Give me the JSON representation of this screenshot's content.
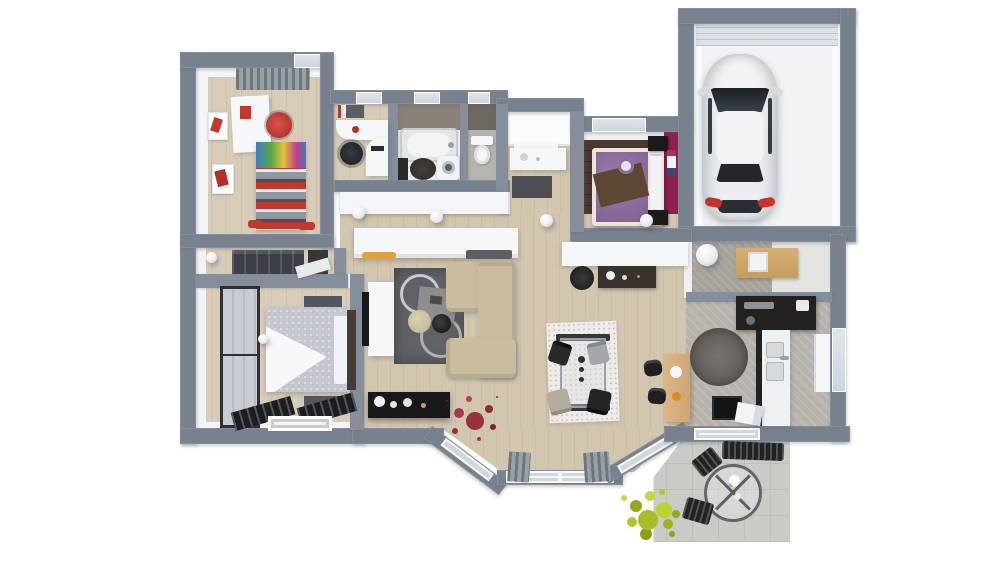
{
  "scene": {
    "description": "3D top-down cutaway floor plan render of a single-storey house with attached garage and outdoor terrace, white background, no text labels",
    "view": "top-down 3d cutaway",
    "palette": {
      "exterior_wall": "#78828f",
      "interior_wall": "#858e9a",
      "wood_floor": "#d8ccb8",
      "dark_wood_floor": "#4a392d",
      "magenta_accent_wall": "#8e2050",
      "kitchen_floor": "#b6b2ac",
      "terrace_concrete": "#cacbc6",
      "sofa_beige": "#c9bc9f",
      "living_rug_gray": "#606266",
      "car_white": "#f1f2f3",
      "kid_bed_red": "#c0392f",
      "purple_bedding": "#8a6b9e",
      "brown_throw": "#5d4733",
      "plant_red": "#9e3340",
      "plant_green": "#b5c52d",
      "counter_dark": "#23211f",
      "bar_wood": "#d9b483"
    },
    "rooms": [
      {
        "id": "kids-bedroom",
        "label": "children's bedroom",
        "furniture": [
          "gray window curtain",
          "white desk",
          "red desk chair",
          "single bed with red-gray striped duvet",
          "colorful print headboard",
          "wall posters",
          "red slippers"
        ]
      },
      {
        "id": "office",
        "label": "study / office",
        "furniture": [
          "white corner desk",
          "black office chair",
          "wall shelf with books",
          "skylight window"
        ]
      },
      {
        "id": "bathroom",
        "label": "bathroom",
        "furniture": [
          "bathtub",
          "washing machine",
          "dark round rug",
          "dark vanity",
          "skylight window",
          "taupe tiled wall"
        ]
      },
      {
        "id": "wc",
        "label": "toilet room",
        "furniture": [
          "toilet",
          "skylight window",
          "dark tiled wall"
        ]
      },
      {
        "id": "entry",
        "label": "entrance hall",
        "furniture": [
          "front porch",
          "white console table",
          "dark doormat"
        ]
      },
      {
        "id": "bedroom-2",
        "label": "bedroom 2",
        "furniture": [
          "double bed with purple bedding and brown throw",
          "two dark nightstands",
          "magenta accent wall",
          "framed picture",
          "window"
        ]
      },
      {
        "id": "garage",
        "label": "garage",
        "furniture": [
          "white car seen from above",
          "sectional garage door"
        ]
      },
      {
        "id": "dressing",
        "label": "dressing room",
        "furniture": [
          "dark wardrobe units",
          "white shelf",
          "ceiling lamp"
        ]
      },
      {
        "id": "master-bedroom",
        "label": "master bedroom",
        "furniture": [
          "sliding-door wardrobe",
          "double bed with gray patterned duvet and white throw",
          "dark headboard",
          "two bedside mats",
          "floor-level windows with louver shutters",
          "bedside lamp"
        ]
      },
      {
        "id": "hallway",
        "label": "hallway",
        "furniture": [
          "white low cabinets",
          "orange tray",
          "three ball ceiling lamps"
        ]
      },
      {
        "id": "living-room",
        "label": "living room",
        "furniture": [
          "white tv sideboard",
          "flat tv",
          "graphic gray rug with circle pattern",
          "gray coffee table",
          "beige round pouf",
          "black round side table",
          "beige corner sofa",
          "black console with white vases",
          "red indoor plant",
          "bay window with gray curtains"
        ]
      },
      {
        "id": "dining-area",
        "label": "dining area",
        "furniture": [
          "white speckled rug",
          "glass dining table",
          "four chairs (black, gray, beige)",
          "candle decor",
          "wooden breakfast bar",
          "two black stools"
        ]
      },
      {
        "id": "kitchen",
        "label": "kitchen",
        "furniture": [
          "dark counter run with oven",
          "white sink counter with double basin",
          "dark base cabinet",
          "round gray rug",
          "cooktop block",
          "window to garden",
          "white towel box"
        ]
      },
      {
        "id": "utility-room",
        "label": "utility / cellar room",
        "furniture": [
          "wooden cabinet",
          "white storage box",
          "ball ceiling lamp"
        ]
      },
      {
        "id": "terrace",
        "label": "terrace",
        "furniture": [
          "round glass garden table",
          "two black slatted chairs",
          "black slatted bench",
          "green shrub",
          "white table flower"
        ]
      }
    ]
  }
}
